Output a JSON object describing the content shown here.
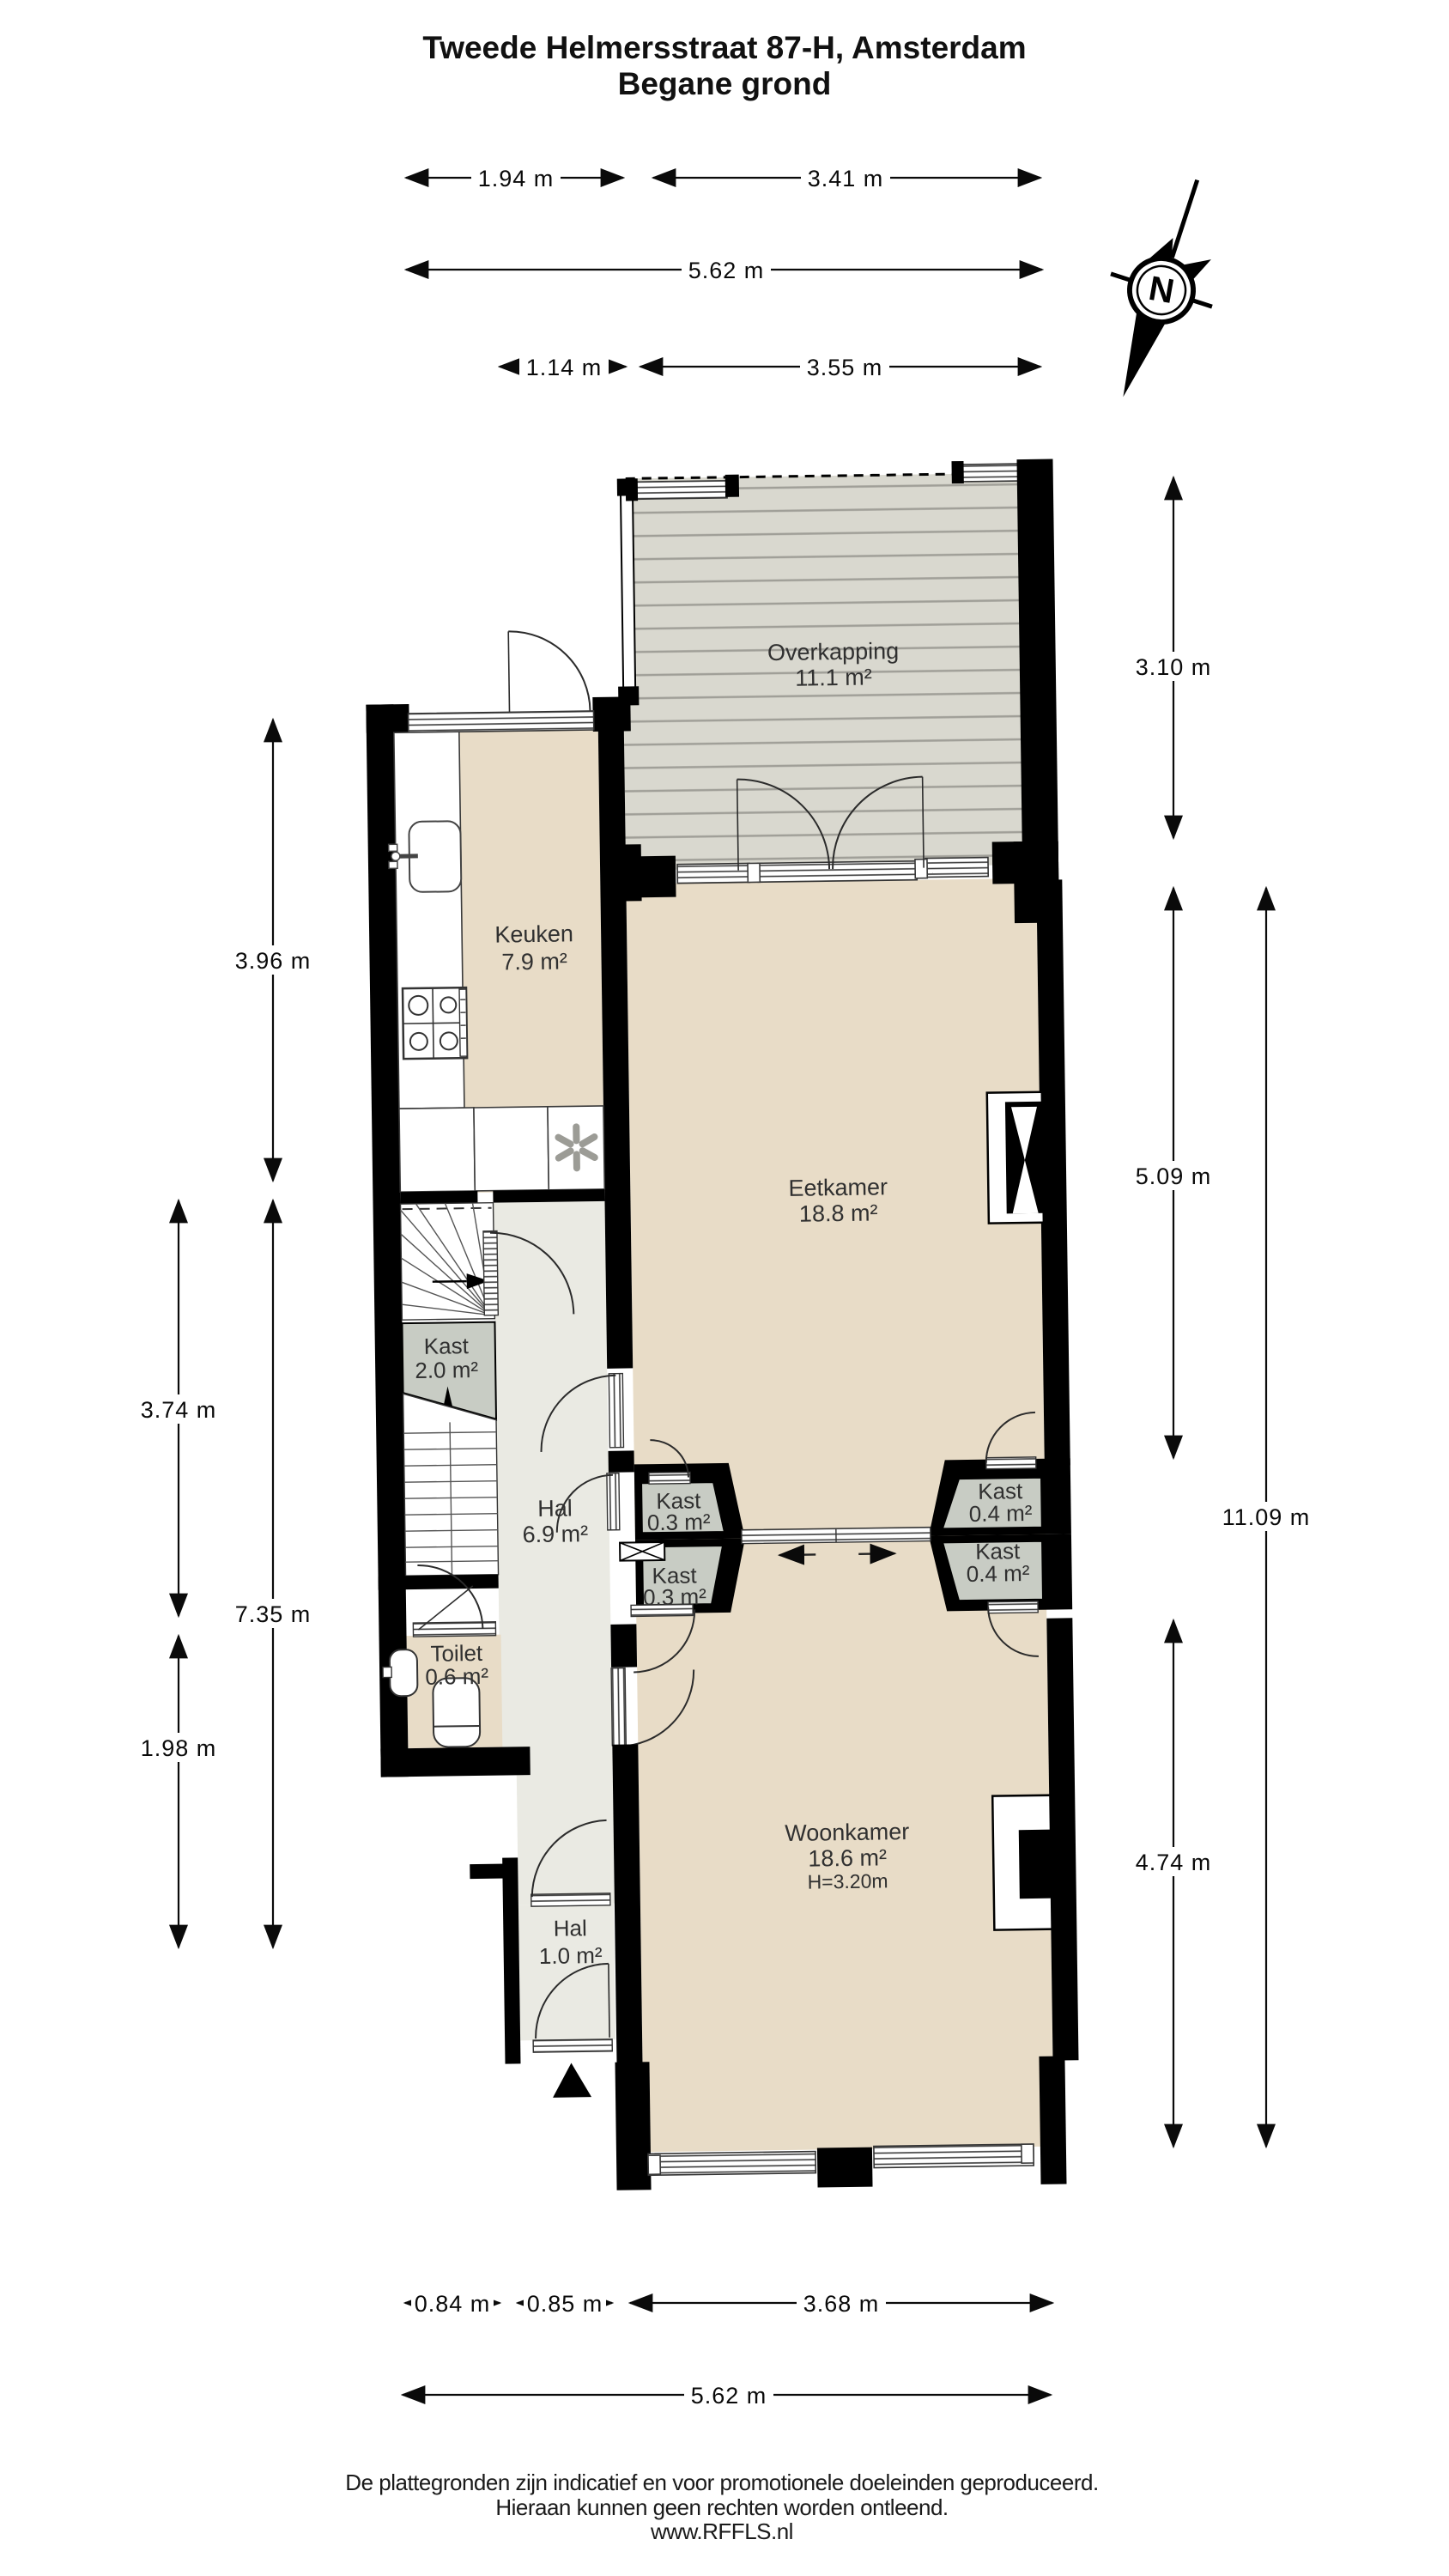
{
  "title": {
    "line1": "Tweede Helmersstraat 87-H, Amsterdam",
    "line2": "Begane grond"
  },
  "compass": {
    "label": "N"
  },
  "rooms": {
    "overkapping": {
      "name": "Overkapping",
      "area": "11.1 m²"
    },
    "keuken": {
      "name": "Keuken",
      "area": "7.9 m²"
    },
    "eetkamer": {
      "name": "Eetkamer",
      "area": "18.8 m²"
    },
    "kast_trap": {
      "name": "Kast",
      "area": "2.0 m²"
    },
    "hal": {
      "name": "Hal",
      "area": "6.9 m²"
    },
    "kast_left_top": {
      "name": "Kast",
      "area": "0.3 m²"
    },
    "kast_left_bottom": {
      "name": "Kast",
      "area": "0.3 m²"
    },
    "kast_right_top": {
      "name": "Kast",
      "area": "0.4 m²"
    },
    "kast_right_bottom": {
      "name": "Kast",
      "area": "0.4 m²"
    },
    "toilet": {
      "name": "Toilet",
      "area": "0.6 m²"
    },
    "woonkamer": {
      "name": "Woonkamer",
      "area": "18.6 m²",
      "height": "H=3.20m"
    },
    "hal_entree": {
      "name": "Hal",
      "area": "1.0 m²"
    }
  },
  "dimensions": {
    "top_194": "1.94 m",
    "top_341": "3.41 m",
    "top_562": "5.62 m",
    "top_114": "1.14 m",
    "top_355": "3.55 m",
    "left_396": "3.96 m",
    "left_735": "7.35 m",
    "left_374": "3.74 m",
    "left_198": "1.98 m",
    "right_310": "3.10 m",
    "right_509": "5.09 m",
    "right_1109": "11.09 m",
    "right_474": "4.74 m",
    "bottom_084": "0.84 m",
    "bottom_085": "0.85 m",
    "bottom_368": "3.68 m",
    "bottom_562": "5.62 m"
  },
  "footer": {
    "line1": "De plattegronden zijn indicatief en voor promotionele doeleinden geproduceerd.",
    "line2": "Hieraan kunnen geen rechten worden ontleend.",
    "line3": "www.RFFLS.nl"
  },
  "colors": {
    "room_fill": "#e8dcc7",
    "hall_fill": "#eaeae3",
    "closet_fill": "#c8ccc4",
    "deck_fill": "#d9d8cf",
    "wall": "#000000"
  }
}
